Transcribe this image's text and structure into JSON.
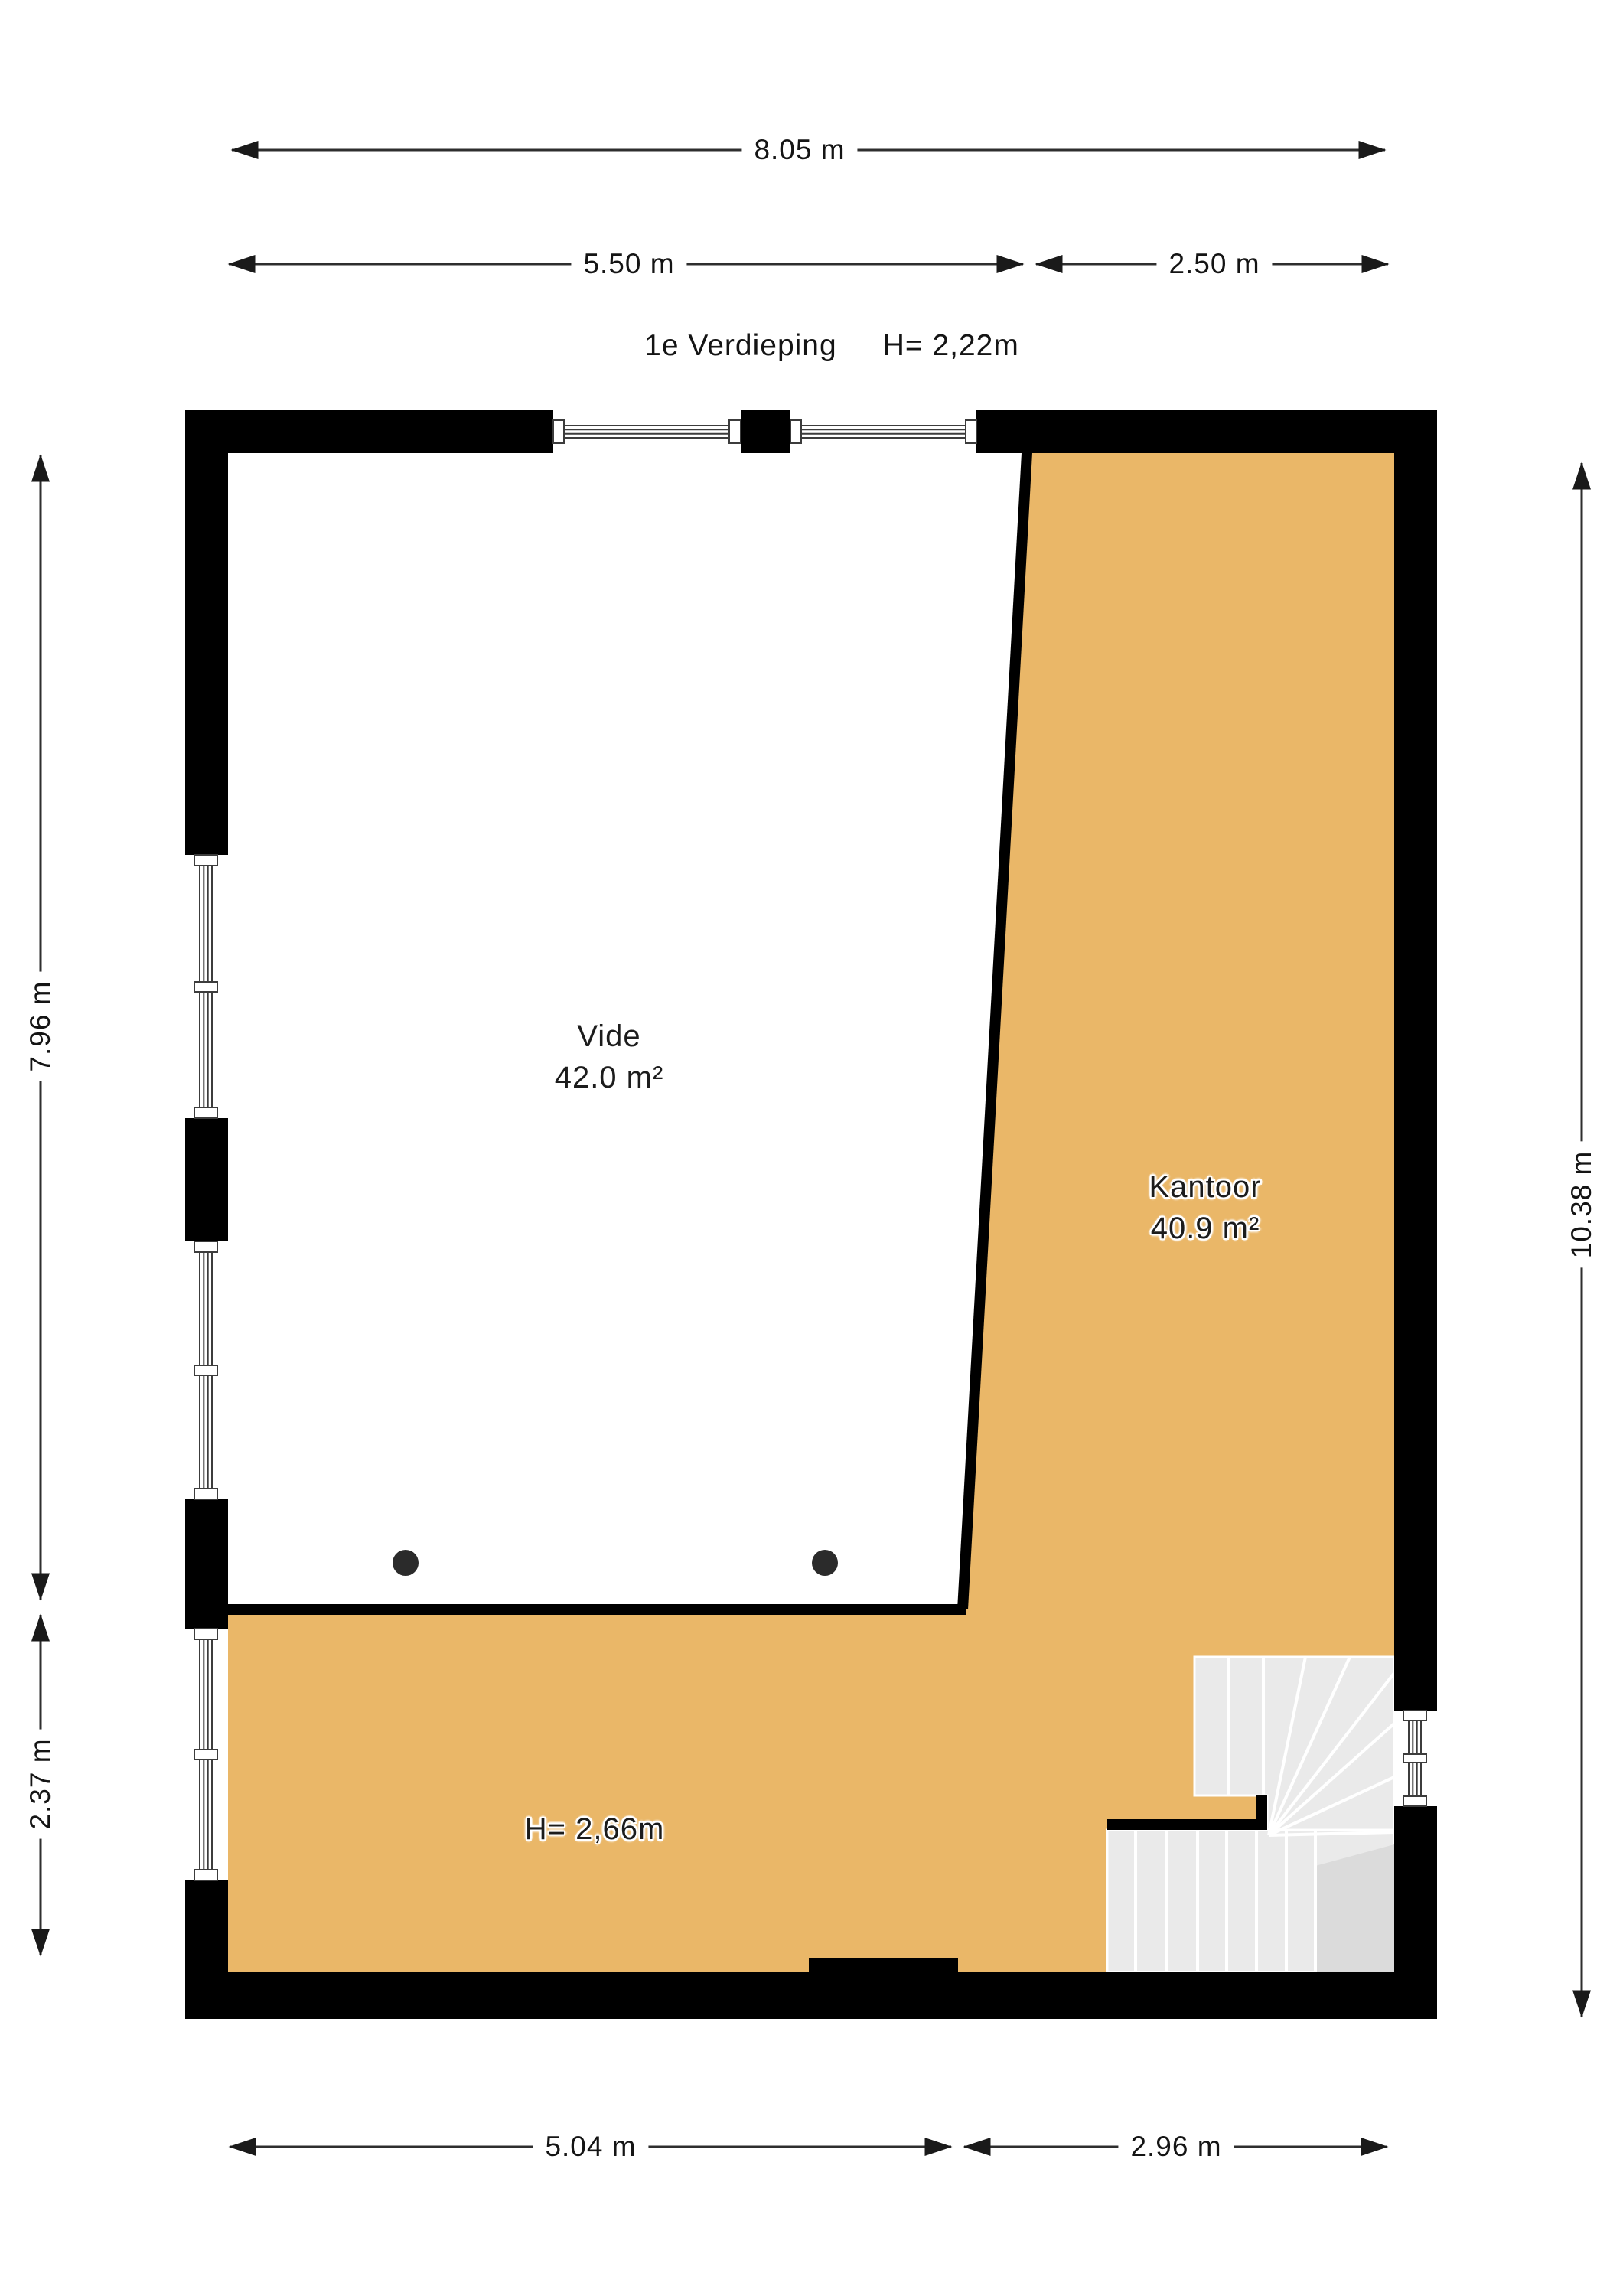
{
  "title": {
    "floor": "1e Verdieping",
    "height": "H= 2,22m"
  },
  "dimensions": {
    "top_total": "8.05 m",
    "top_left": "5.50 m",
    "top_right": "2.50 m",
    "left_upper": "7.96 m",
    "left_lower": "2.37 m",
    "right_total": "10.38 m",
    "bottom_left": "5.04 m",
    "bottom_right": "2.96 m"
  },
  "rooms": [
    {
      "name": "Vide",
      "area": "42.0 m²"
    },
    {
      "name": "Kantoor",
      "area": "40.9 m²"
    }
  ],
  "annotations": {
    "lower_height": "H= 2,66m"
  },
  "colors": {
    "floor": "#EAB768",
    "wall": "#000000",
    "stair": "#EAEAEA",
    "stair_dark": "#DBDBDB",
    "dot": "#2B2B2B",
    "dim_line": "#2E2E2E",
    "window_line": "#3C3C3C"
  }
}
